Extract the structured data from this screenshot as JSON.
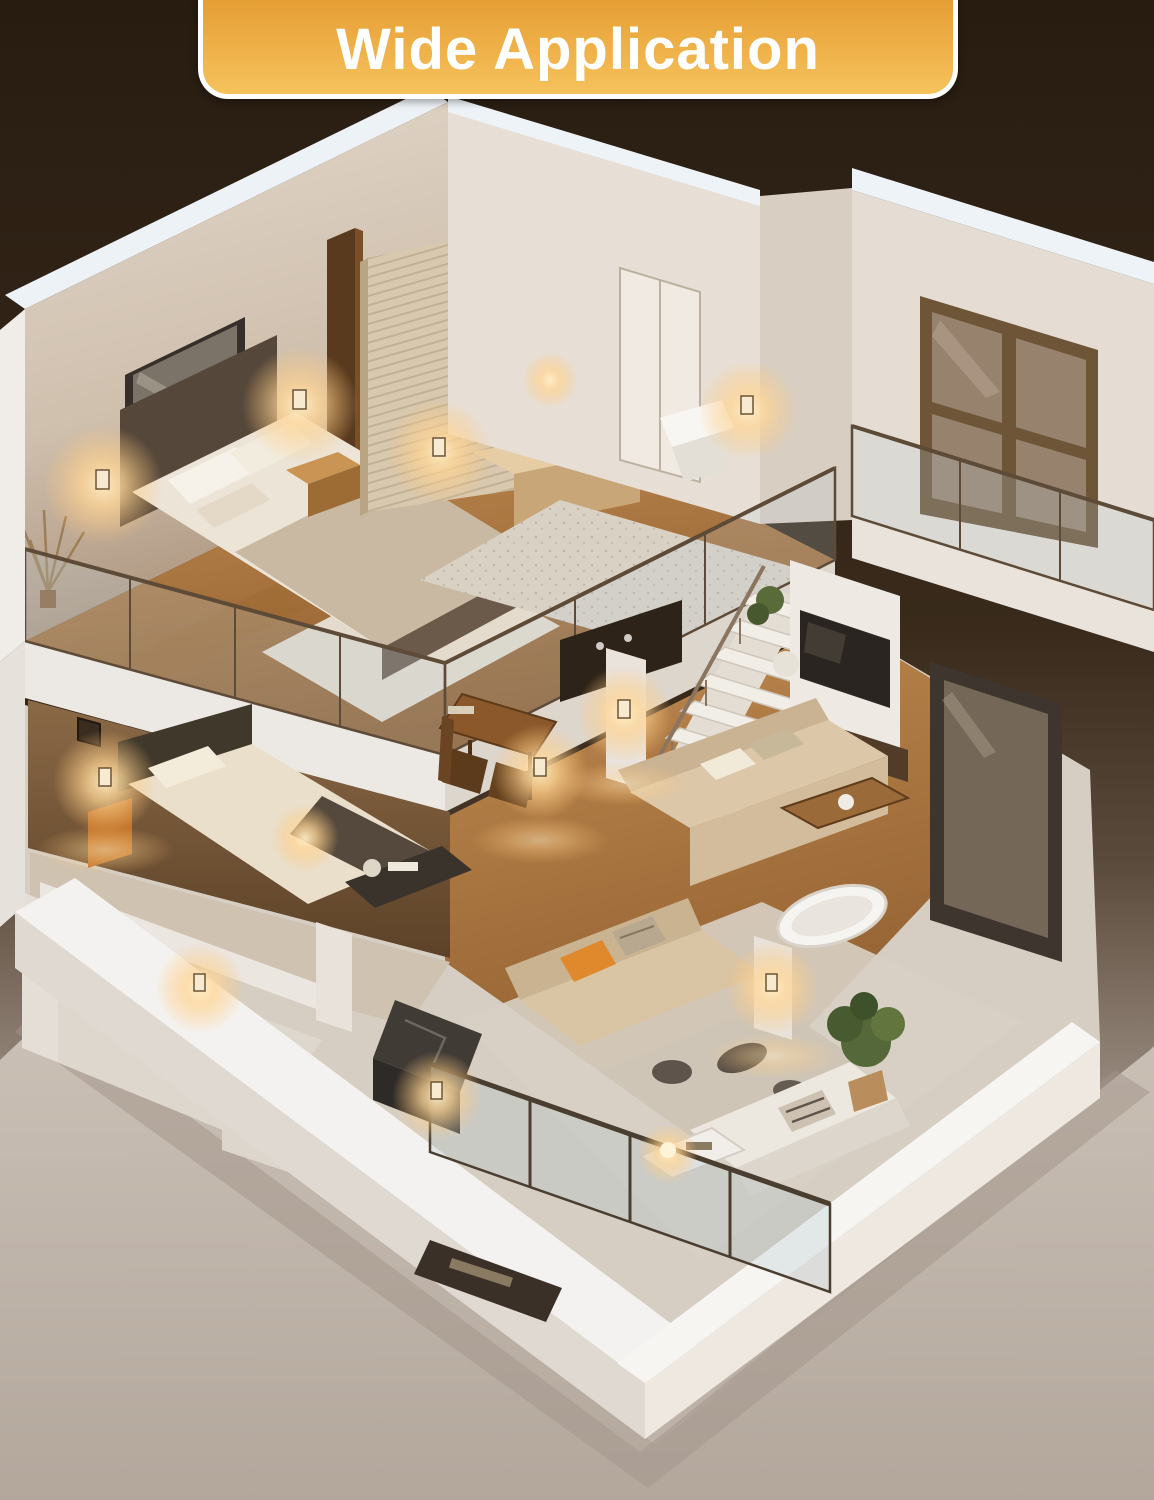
{
  "banner": {
    "label": "Wide Application",
    "background_top": "#e39c31",
    "background_bottom": "#f5c25c",
    "border_color": "#ffffff",
    "text_color": "#ffffff"
  },
  "scene": {
    "type": "3d-isometric-apartment-cutaway",
    "backdrop_top": "#2a1d12",
    "backdrop_bottom": "#b6aaa0",
    "wall_white": "#e9e4de",
    "wall_beige": "#cdbca9",
    "wood_floor": "#b07f49",
    "glow_color": "#ffd9a2",
    "visible_wall_lights": 13,
    "rooms": [
      "loft-bedroom",
      "vanity-corner",
      "upper-bathroom",
      "upper-landing",
      "staircase",
      "lower-bedroom",
      "kitchen-dining",
      "living-room",
      "lounge",
      "lower-bathroom",
      "balcony"
    ]
  }
}
